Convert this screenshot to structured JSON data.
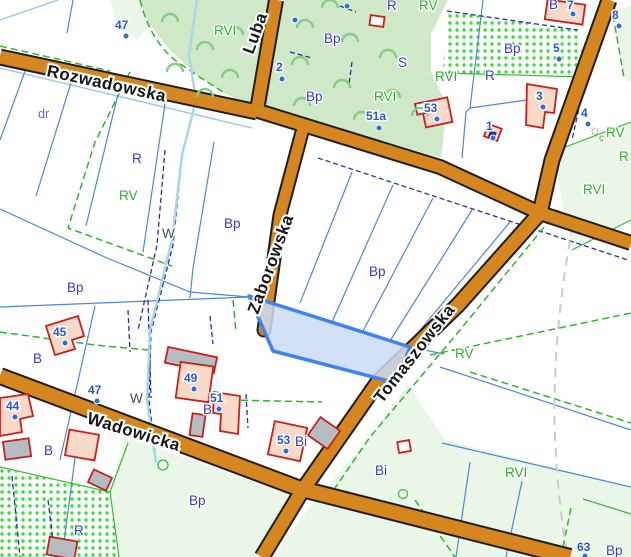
{
  "map": {
    "streets": [
      {
        "label": "Rozwadowska"
      },
      {
        "label": "Luba"
      },
      {
        "label": "Zaborowska"
      },
      {
        "label": "Tomaszowska"
      },
      {
        "label": "Wadowicka"
      }
    ],
    "landuse_labels": [
      {
        "text": "dr"
      },
      {
        "text": "R"
      },
      {
        "text": "RV"
      },
      {
        "text": "W"
      },
      {
        "text": "Bp"
      },
      {
        "text": "Bp"
      },
      {
        "text": "Bp"
      },
      {
        "text": "RVI"
      },
      {
        "text": "Bp"
      },
      {
        "text": "S"
      },
      {
        "text": "Bp"
      },
      {
        "text": "RVI"
      },
      {
        "text": "R"
      },
      {
        "text": "RV"
      },
      {
        "text": "Bp"
      },
      {
        "text": "RVI"
      },
      {
        "text": "R"
      },
      {
        "text": "RVI"
      },
      {
        "text": "RV"
      },
      {
        "text": "R"
      },
      {
        "text": "RV"
      },
      {
        "text": "RVI"
      },
      {
        "text": "Bi"
      },
      {
        "text": "Bi"
      },
      {
        "text": "Bp"
      },
      {
        "text": "Bp"
      },
      {
        "text": "R"
      },
      {
        "text": "B"
      },
      {
        "text": "B"
      },
      {
        "text": "B"
      },
      {
        "text": "W"
      },
      {
        "text": "B"
      },
      {
        "text": "c"
      }
    ],
    "markers": [
      {
        "text": "47"
      },
      {
        "text": "2"
      },
      {
        "text": "51a"
      },
      {
        "text": "53"
      },
      {
        "text": "7"
      },
      {
        "text": "8"
      },
      {
        "text": "5"
      },
      {
        "text": "3"
      },
      {
        "text": "1"
      },
      {
        "text": "4"
      },
      {
        "text": "45"
      },
      {
        "text": "44"
      },
      {
        "text": "47"
      },
      {
        "text": "49"
      },
      {
        "text": "51"
      },
      {
        "text": "53"
      },
      {
        "text": "63"
      }
    ],
    "icons": {
      "sun": "☼"
    },
    "colors": {
      "road_fill": "#d5861e",
      "road_casing": "#1e1e1e",
      "park_green": "#cfe8c8",
      "pale_green": "#eaf6e7",
      "stipple_dot": "#3bdc3b",
      "selection_fill": "#cadcf5",
      "selection_stroke": "#3f83f2",
      "parcel_line_blue": "#4f86d8",
      "boundary_navy_dashed": "#2c2ca2",
      "boundary_green_dashed": "#2eb42e",
      "stream_blue": "#a9d7ea",
      "contour_gray": "#cbcbcb",
      "building_outline": "#c9201d",
      "building_fill": "#f6d9c7",
      "building_gray": "#b6bdc2",
      "marker_blue": "#2458d6",
      "landuse_navy": "#3a3ac6",
      "landuse_green": "#2fae2f"
    }
  }
}
